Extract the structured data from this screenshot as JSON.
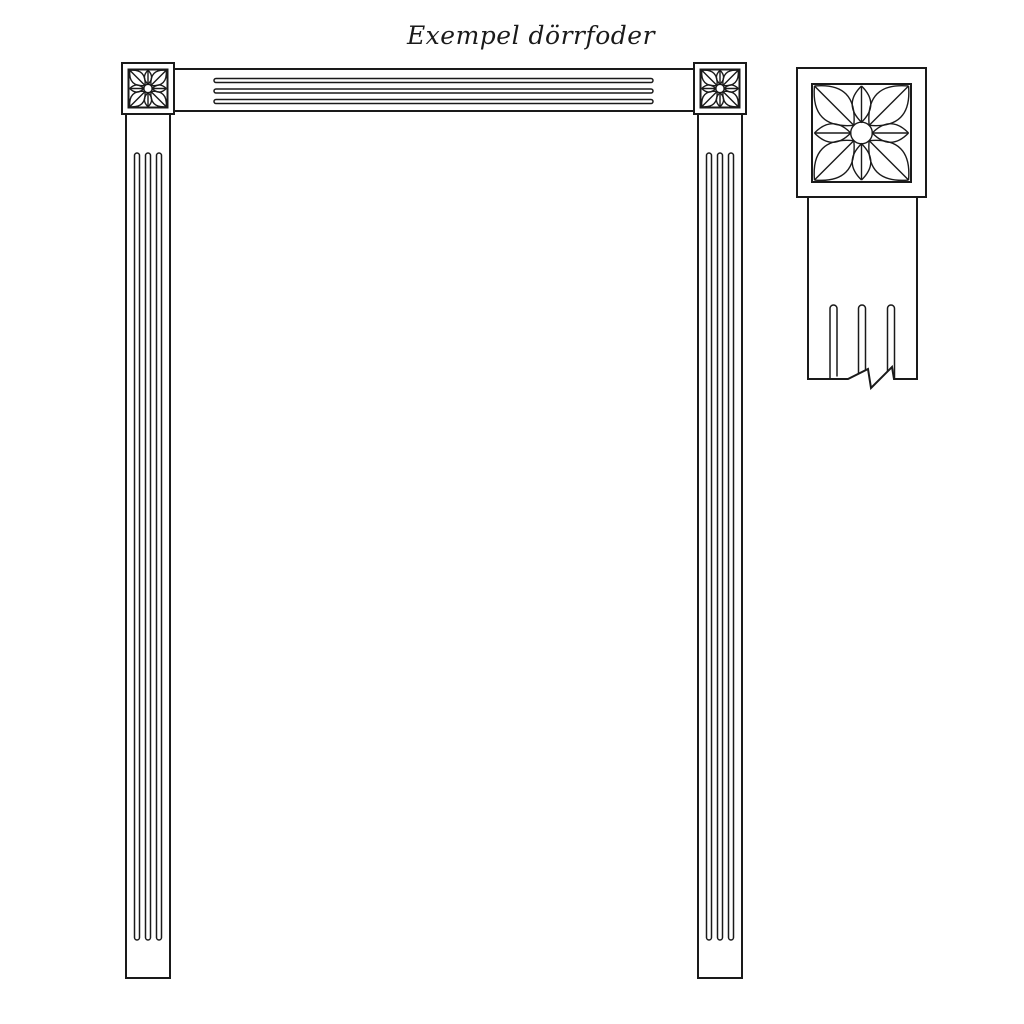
{
  "title": "Exempel dörrfoder",
  "colors": {
    "background": "#ffffff",
    "line": "#1a1a1a"
  }
}
